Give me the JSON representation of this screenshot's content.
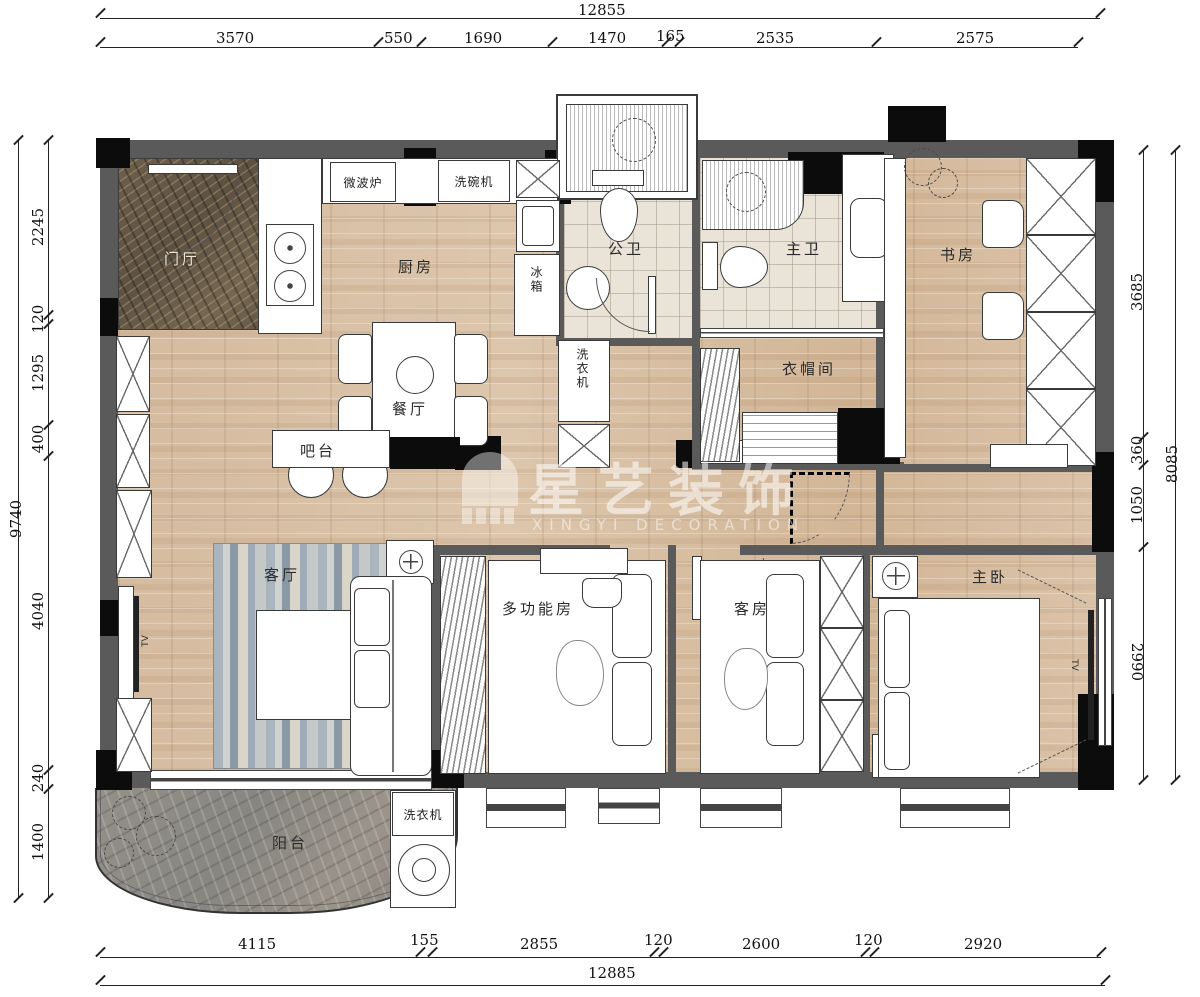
{
  "dimensions": {
    "top": {
      "total": "12855",
      "segments": [
        "3570",
        "550",
        "1690",
        "1470",
        "165",
        "2535",
        "2575"
      ]
    },
    "bottom": {
      "total": "12885",
      "segments": [
        "4115",
        "155",
        "2855",
        "120",
        "2600",
        "120",
        "2920"
      ]
    },
    "left": {
      "total": "9740",
      "segments": [
        "2245",
        "120",
        "1295",
        "400",
        "4040",
        "240",
        "1400"
      ]
    },
    "right": {
      "total": "8085",
      "segments": [
        "3685",
        "360",
        "1050",
        "2990"
      ]
    }
  },
  "rooms": {
    "entry": "门厅",
    "kitchen": "厨房",
    "public_bath": "公卫",
    "master_bath": "主卫",
    "study": "书房",
    "cloakroom": "衣帽间",
    "dining": "餐厅",
    "bar": "吧台",
    "living": "客厅",
    "multi": "多功能房",
    "guest": "客房",
    "master": "主卧",
    "balcony": "阳台"
  },
  "appliances": {
    "microwave": "微波炉",
    "dishwasher": "洗碗机",
    "fridge": "冰箱",
    "washer_hall": "洗衣机",
    "washer_balcony": "洗衣机",
    "tv_living": "TV",
    "tv_master": "TV"
  },
  "watermark": {
    "cn": "星艺装饰",
    "en": "XINGYI DECORATION"
  },
  "colors": {
    "wall_gray": "#5a5a5a",
    "column_black": "#0c0c0c",
    "wood_floor": "#d8c0a6",
    "entry_marble": "#64573f",
    "balcony_marble": "#8e8a84",
    "rug_blue": "#9fabb6",
    "tile": "#eae3d7",
    "line": "#222222"
  }
}
